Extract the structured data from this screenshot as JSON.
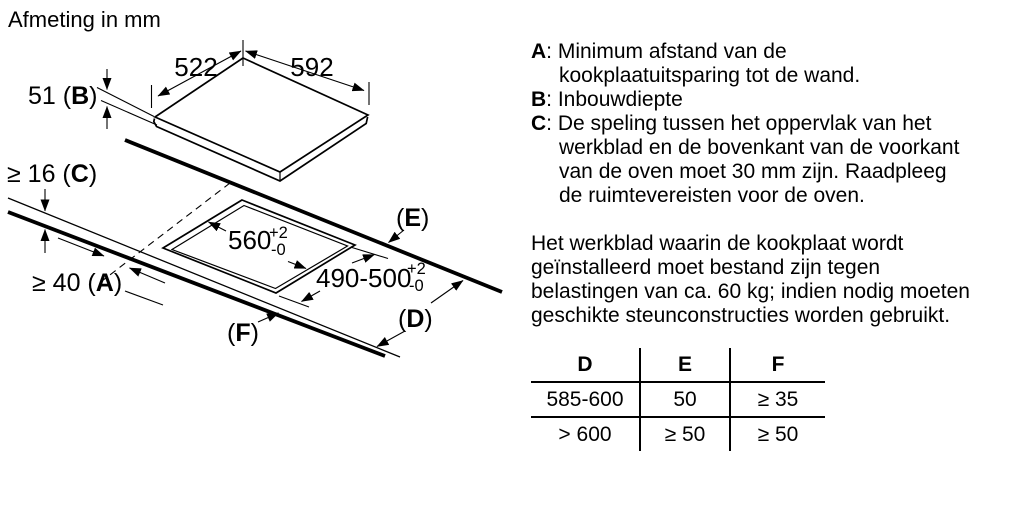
{
  "diagram": {
    "title": "Afmeting in mm",
    "top_depth": "522",
    "top_width": "592",
    "thickness": {
      "pre": "51 (",
      "letter": "B",
      "post": ")"
    },
    "clearance": {
      "pre": "≥ 16 (",
      "letter": "C",
      "post": ")"
    },
    "wall_distance": {
      "pre": "≥ 40 (",
      "letter": "A",
      "post": ")"
    },
    "label_e": {
      "pre": "(",
      "letter": "E",
      "post": ")"
    },
    "label_d": {
      "pre": "(",
      "letter": "D",
      "post": ")"
    },
    "label_f": {
      "pre": "(",
      "letter": "F",
      "post": ")"
    },
    "cutout_width": {
      "value": "560",
      "tol_plus": "+2",
      "tol_minus": "-0"
    },
    "cutout_depth": {
      "value": "490-500",
      "tol_plus": "+2",
      "tol_minus": "-0"
    }
  },
  "legend": {
    "sep": ": ",
    "items": [
      {
        "letter": "A",
        "text": "Minimum afstand van de kookplaatuitsparing tot de wand."
      },
      {
        "letter": "B",
        "text": "Inbouwdiepte"
      },
      {
        "letter": "C",
        "text": "De speling tussen het oppervlak van het werkblad en de bovenkant van de voorkant van de oven moet 30 mm zijn. Raadpleeg de ruimtevereisten voor de oven."
      }
    ]
  },
  "note": "Het werkblad waarin de kookplaat wordt geïnstalleerd moet bestand zijn tegen belastingen van ca. 60 kg; indien nodig moeten geschikte steunconstructies worden gebruikt.",
  "table": {
    "headers": [
      "D",
      "E",
      "F"
    ],
    "rows": [
      [
        "585-600",
        "50",
        "≥ 35"
      ],
      [
        "> 600",
        "≥ 50",
        "≥ 50"
      ]
    ]
  }
}
